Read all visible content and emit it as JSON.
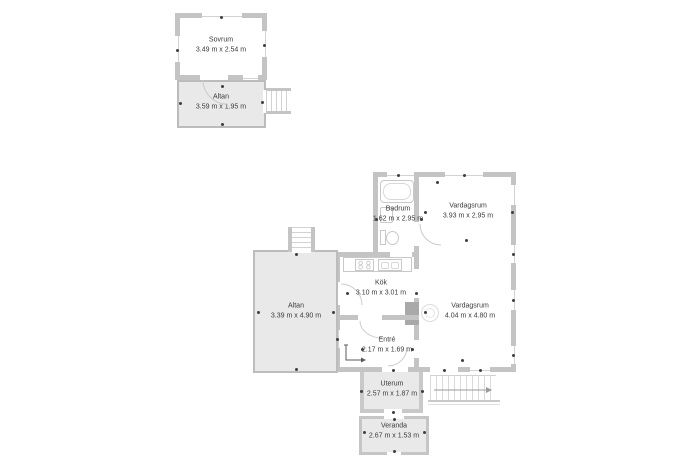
{
  "plan": {
    "rooms": {
      "sovrum": {
        "name": "Sovrum",
        "dims": "3.49 m x 2.54 m"
      },
      "altan_guest": {
        "name": "Altan",
        "dims": "3.59 m x 1.95 m"
      },
      "badrum": {
        "name": "Badrum",
        "dims": "1.62 m x 2.95 m"
      },
      "vardagsrum_upper": {
        "name": "Vardagsrum",
        "dims": "3.93 m x 2.95 m"
      },
      "kok": {
        "name": "Kök",
        "dims": "3.10 m x 3.01 m"
      },
      "altan_main": {
        "name": "Altan",
        "dims": "3.39 m x 4.90 m"
      },
      "vardagsrum_lower": {
        "name": "Vardagsrum",
        "dims": "4.04 m x 4.80 m"
      },
      "entre": {
        "name": "Entré",
        "dims": "2.17 m x 1.69 m"
      },
      "uterum": {
        "name": "Uterum",
        "dims": "2.57 m x 1.87 m"
      },
      "veranda": {
        "name": "Veranda",
        "dims": "2.67 m x 1.53 m"
      }
    },
    "colors": {
      "wall": "#c4c4c4",
      "deck_fill": "#e9e9e9",
      "text": "#3a3a3a"
    }
  }
}
